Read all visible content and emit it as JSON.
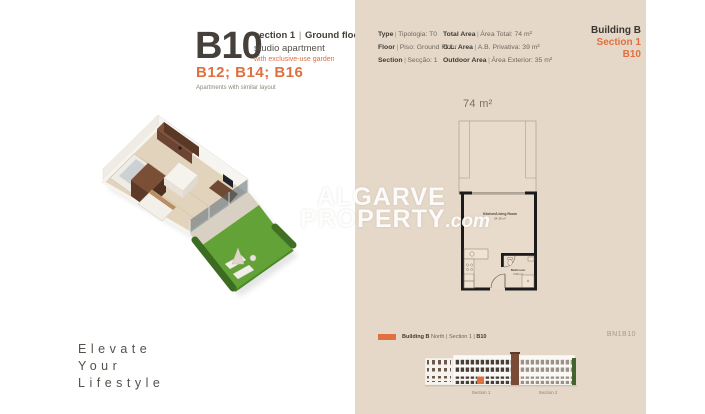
{
  "accent_color": "#e0703f",
  "panel_color": "#e5d8c9",
  "ui": {
    "pipe": "|"
  },
  "left": {
    "unit_code": "B10",
    "section_label": "section 1",
    "floor_label": "Ground floor",
    "subtitle": "studio apartment",
    "garden_note": "with exclusive-use garden",
    "similar_units": "B12; B14; B16",
    "similar_note": "Apartments with similar layout",
    "tagline": [
      "Elevate",
      "Your",
      "Lifestyle"
    ]
  },
  "specs": {
    "col1": [
      {
        "en": "Type",
        "pt": "Tipologia: T0"
      },
      {
        "en": "Floor",
        "pt": "Piso: Ground Floor"
      },
      {
        "en": "Section",
        "pt": "Secção: 1"
      }
    ],
    "col2": [
      {
        "en": "Total Area",
        "pt": "Área Total: 74 m²"
      },
      {
        "en": "G.L. Area",
        "pt": "A.B. Privativa: 39 m²"
      },
      {
        "en": "Outdoor Area",
        "pt": "Área Exterior: 35 m²"
      }
    ]
  },
  "building_ref": {
    "building": "Building B",
    "section": "Section 1",
    "unit": "B10"
  },
  "plan": {
    "total_area": "74 m²",
    "rooms": [
      {
        "name": "Kitchen/Living Room",
        "area": "34.30 m²"
      },
      {
        "name": "Bathroom",
        "area": "4.50 m²"
      }
    ]
  },
  "watermark": {
    "line1": "ALGARVE",
    "line2": "PROPERTY",
    "suffix": ".com"
  },
  "legend": {
    "bold1": "Building B",
    "mid": " North | Section 1 | ",
    "bold2": "B10",
    "code": "BN1B10"
  },
  "elevation": {
    "sections": [
      "Section 1",
      "Section 2"
    ]
  }
}
